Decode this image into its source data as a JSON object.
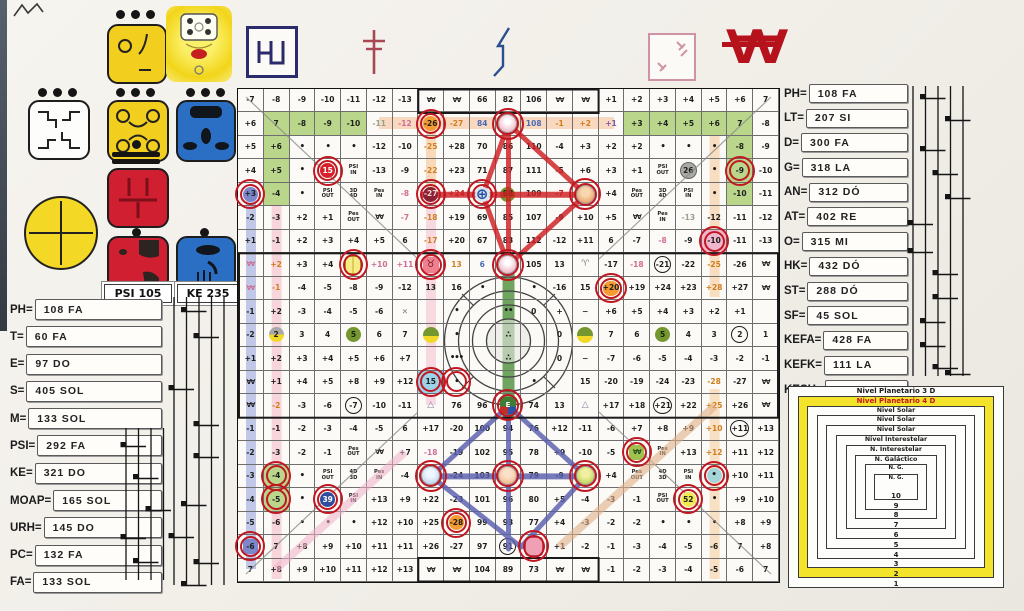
{
  "seals": {
    "psi_label": "PSI 105",
    "ke_label": "KE 235",
    "icons": [
      "white-seal",
      "yellow-seal-1",
      "sun-face",
      "yellow-seal-2",
      "blue-seal-1",
      "yellow-circle-cross",
      "red-seal-1",
      "red-seal-2",
      "blue-seal-2"
    ]
  },
  "top_symbols": {
    "w_glyph": "∀∀"
  },
  "left_panel": {
    "items": [
      {
        "label": "PH=",
        "value": "108 FA"
      },
      {
        "label": "T=",
        "value": "60 FA"
      },
      {
        "label": "E=",
        "value": "97 DO"
      },
      {
        "label": "S=",
        "value": "405 SOL"
      },
      {
        "label": "M=",
        "value": "133 SOL"
      },
      {
        "label": "PSI=",
        "value": "292 FA"
      },
      {
        "label": "KE=",
        "value": "321 DO"
      },
      {
        "label": "MOAP=",
        "value": "165 SOL"
      },
      {
        "label": "URH=",
        "value": "145 DO"
      },
      {
        "label": "PC=",
        "value": "132 FA"
      },
      {
        "label": "FA=",
        "value": "133 SOL"
      }
    ]
  },
  "right_panel": {
    "items": [
      {
        "label": "PH=",
        "value": "108 FA"
      },
      {
        "label": "LT=",
        "value": "207 SI"
      },
      {
        "label": "D=",
        "value": "300 FA"
      },
      {
        "label": "G=",
        "value": "318 LA"
      },
      {
        "label": "AN=",
        "value": "312 DÓ"
      },
      {
        "label": "AT=",
        "value": "402 RE"
      },
      {
        "label": "O=",
        "value": "315 MI"
      },
      {
        "label": "HK=",
        "value": "432 DÓ"
      },
      {
        "label": "ST=",
        "value": "288 DÓ"
      },
      {
        "label": "SF=",
        "value": "45 SOL"
      },
      {
        "label": "KEFA=",
        "value": "428 FA"
      },
      {
        "label": "KEFK=",
        "value": "111 LA"
      },
      {
        "label": "KESH=",
        "value": "367 SI"
      }
    ]
  },
  "nested_squares": {
    "rings": [
      {
        "label": "Nivel Planetario 3 D",
        "number": "1",
        "style": "plain"
      },
      {
        "label": "Nivel Planetario 4 D",
        "number": "2",
        "style": "yellow"
      },
      {
        "label": "Nivel Solar",
        "number": "3",
        "style": "plain"
      },
      {
        "label": "Nivel Solar",
        "number": "4",
        "style": "plain"
      },
      {
        "label": "Nivel Solar",
        "number": "5",
        "style": "plain"
      },
      {
        "label": "Nivel Interestelar",
        "number": "6",
        "style": "plain"
      },
      {
        "label": "N. Interestelar",
        "number": "7",
        "style": "plain"
      },
      {
        "label": "N. Galáctico",
        "number": "8",
        "style": "plain"
      },
      {
        "label": "N. G.",
        "number": "9",
        "style": "plain"
      },
      {
        "label": "N. G.",
        "number": "10",
        "style": "plain"
      }
    ]
  },
  "staffs": {
    "left": {
      "lines": 5,
      "height": 288,
      "notes": [
        [
          1,
          10
        ],
        [
          2,
          36
        ],
        [
          0,
          88
        ],
        [
          2,
          124
        ],
        [
          2,
          156
        ],
        [
          1,
          204
        ],
        [
          0,
          236
        ],
        [
          2,
          262
        ],
        [
          1,
          284
        ]
      ]
    },
    "bottom_left": {
      "lines": 4,
      "height": 152,
      "notes": [
        [
          0,
          14
        ],
        [
          1,
          46
        ],
        [
          2,
          78
        ],
        [
          0,
          106
        ],
        [
          1,
          130
        ]
      ]
    },
    "right": {
      "lines": 5,
      "height": 290,
      "notes": [
        [
          1,
          8
        ],
        [
          3,
          30
        ],
        [
          1,
          60
        ],
        [
          2,
          84
        ],
        [
          3,
          108
        ],
        [
          0,
          134
        ],
        [
          0,
          162
        ],
        [
          2,
          184
        ],
        [
          2,
          208
        ],
        [
          1,
          232
        ],
        [
          1,
          256
        ],
        [
          2,
          278
        ],
        [
          3,
          284
        ]
      ]
    }
  },
  "grid": {
    "rows": [
      [
        "-7",
        "-8",
        "-9",
        "-10",
        "-11",
        "-12",
        "-13",
        {
          "t": "∀∀",
          "c": "w"
        },
        {
          "t": "∀∀",
          "c": "w"
        },
        "66",
        "82",
        "106",
        {
          "t": "∀∀",
          "c": "w"
        },
        {
          "t": "∀∀",
          "c": "w"
        },
        "+1",
        "+2",
        "+3",
        "+4",
        "+5",
        "+6",
        "7"
      ],
      [
        "+6",
        {
          "t": "7",
          "c": "g"
        },
        {
          "t": "-8",
          "c": "g"
        },
        {
          "t": "-9",
          "c": "g"
        },
        {
          "t": "-10",
          "c": "g"
        },
        {
          "t": "-11",
          "c": "txt-gr"
        },
        {
          "t": "-12",
          "c": "txt-p"
        },
        {
          "t": "-26",
          "c": "oc",
          "r": 1
        },
        {
          "t": "-27",
          "c": "txt-o"
        },
        {
          "t": "84",
          "c": "txt-b"
        },
        {
          "t": "",
          "c": "fig fig-rose",
          "r": 1
        },
        {
          "t": "108",
          "c": "txt-b"
        },
        {
          "t": "-1",
          "c": "txt-o"
        },
        {
          "t": "+2",
          "c": "txt-o"
        },
        {
          "t": "+1",
          "c": "txt-v"
        },
        {
          "t": "+3",
          "c": "g"
        },
        {
          "t": "+4",
          "c": "g"
        },
        {
          "t": "+5",
          "c": "g"
        },
        {
          "t": "+6",
          "c": "g"
        },
        {
          "t": "7",
          "c": "g"
        },
        "-8"
      ],
      [
        "+5",
        {
          "t": "+6",
          "c": "g"
        },
        {
          "t": "•",
          "c": "dot"
        },
        {
          "t": "•",
          "c": "dot"
        },
        {
          "t": "•",
          "c": "dot"
        },
        "-12",
        "-10",
        {
          "t": "-25",
          "c": "txt-o"
        },
        "+28",
        "70",
        "86",
        "110",
        "-4",
        "+3",
        "+2",
        "+2",
        {
          "t": "•",
          "c": "dot"
        },
        {
          "t": "•",
          "c": "dot"
        },
        {
          "t": "•",
          "c": "dot"
        },
        {
          "t": "-8",
          "c": "g"
        },
        "-9"
      ],
      [
        "+4",
        {
          "t": "+5",
          "c": "g"
        },
        {
          "t": "•",
          "c": "dot"
        },
        {
          "t": "15",
          "c": "rc",
          "r": 1
        },
        {
          "t": "PSI IN",
          "c": "sm"
        },
        "-13",
        "-9",
        {
          "t": "-22",
          "c": "txt-o"
        },
        "+23",
        "71",
        "87",
        "111",
        "-5",
        "+6",
        "+3",
        "+1",
        {
          "t": "PSI OUT",
          "c": "sm"
        },
        {
          "t": "26",
          "c": "grc"
        },
        {
          "t": "•",
          "c": "dot"
        },
        {
          "t": "-9",
          "c": "g",
          "r": 1
        },
        "-10"
      ],
      [
        {
          "t": "+3",
          "c": "bc",
          "r": 1
        },
        {
          "t": "-4",
          "c": "g"
        },
        {
          "t": "•",
          "c": "dot"
        },
        {
          "t": "PSI OUT",
          "c": "sm"
        },
        {
          "t": "3D 4D",
          "c": "sm"
        },
        {
          "t": "Pes IN",
          "c": "sm"
        },
        {
          "t": "-8",
          "c": "txt-p"
        },
        {
          "t": "-27",
          "c": "mc",
          "r": 1
        },
        {
          "t": "+24",
          "c": "txt-r"
        },
        {
          "t": "⊕",
          "c": "globe",
          "r": 1
        },
        {
          "t": "88",
          "c": "gc"
        },
        "109",
        {
          "t": "-7",
          "c": "txt-r"
        },
        {
          "t": "",
          "c": "fig fig-orange",
          "r": 1
        },
        "+4",
        {
          "t": "Pes OUT",
          "c": "sm"
        },
        {
          "t": "3D 4D",
          "c": "sm"
        },
        {
          "t": "PSI IN",
          "c": "sm"
        },
        {
          "t": "•",
          "c": "dot"
        },
        {
          "t": "-10",
          "c": "g"
        },
        "-11"
      ],
      [
        "-2",
        "-3",
        "+2",
        "+1",
        {
          "t": "Pes OUT",
          "c": "sm"
        },
        {
          "t": "∀∀",
          "c": "w"
        },
        {
          "t": "-7",
          "c": "txt-p"
        },
        {
          "t": "-18",
          "c": "txt-o"
        },
        "+19",
        "69",
        "85",
        "107",
        "-9",
        "+10",
        "+5",
        {
          "t": "∀∀",
          "c": "w"
        },
        {
          "t": "Pes IN",
          "c": "sm"
        },
        {
          "t": "-13",
          "c": "txt-gr"
        },
        "-12",
        "-11",
        "-12"
      ],
      [
        "+1",
        "-1",
        "+2",
        "+3",
        "+4",
        "+5",
        "6",
        {
          "t": "-17",
          "c": "txt-o"
        },
        "+20",
        "67",
        "83",
        "112",
        "-12",
        "+11",
        "6",
        "-7",
        {
          "t": "-8",
          "c": "txt-p"
        },
        "-9",
        {
          "t": "-10",
          "c": "pc2",
          "r": 1
        },
        "-11",
        "-13"
      ],
      [
        {
          "t": "∀∀",
          "c": "w txt-p"
        },
        {
          "t": "+2",
          "c": "txt-o"
        },
        "+3",
        "+4",
        {
          "t": "",
          "c": "glyph-y",
          "r": 1
        },
        {
          "t": "+10",
          "c": "txt-p"
        },
        {
          "t": "+11",
          "c": "txt-p"
        },
        {
          "t": "♉",
          "c": "tau",
          "r": 1
        },
        {
          "t": "13",
          "c": "txt-o"
        },
        {
          "t": "6",
          "c": "txt-b"
        },
        {
          "t": "",
          "c": "fig fig-rose",
          "r": 1
        },
        "105",
        "13",
        {
          "t": "♈",
          "c": "ari"
        },
        "-17",
        {
          "t": "-18",
          "c": "txt-p"
        },
        {
          "t": "-21",
          "c": "kc"
        },
        "-22",
        {
          "t": "-25",
          "c": "txt-o"
        },
        "-26",
        {
          "t": "∀∀",
          "c": "w"
        }
      ],
      [
        {
          "t": "∀∀",
          "c": "w txt-p"
        },
        {
          "t": "-1",
          "c": "txt-o"
        },
        "-4",
        "-5",
        "-8",
        "-9",
        "-12",
        "13",
        "16",
        {
          "t": "•",
          "c": "dot"
        },
        "",
        {
          "t": "•",
          "c": "dot"
        },
        "-16",
        "15",
        {
          "t": "+20",
          "c": "oc",
          "r": 1
        },
        "+19",
        "+24",
        "+23",
        {
          "t": "+28",
          "c": "txt-o"
        },
        "+27",
        {
          "t": "∀∀",
          "c": "w"
        }
      ],
      [
        "-1",
        "+2",
        "-3",
        "-4",
        "-5",
        "-6",
        {
          "t": "✕",
          "c": "xg"
        },
        "",
        {
          "t": "•",
          "c": "dot"
        },
        "",
        {
          "t": "••",
          "c": "dot"
        },
        "0",
        "+",
        "−",
        "+6",
        "+5",
        "+4",
        "+3",
        "+2",
        "+1",
        ""
      ],
      [
        "-2",
        {
          "t": "2",
          "c": "hgy"
        },
        "3",
        "4",
        {
          "t": "5",
          "c": "gc"
        },
        "6",
        "7",
        {
          "t": "",
          "c": "hgg"
        },
        {
          "t": "•",
          "c": "dot"
        },
        "",
        {
          "t": "∴",
          "c": "dot"
        },
        "",
        "0",
        {
          "t": "",
          "c": "hgg"
        },
        "7",
        "6",
        {
          "t": "5",
          "c": "gc"
        },
        "4",
        "3",
        {
          "t": "2",
          "c": "kc"
        },
        "1"
      ],
      [
        "+1",
        "+2",
        "+3",
        "+4",
        "+5",
        "+6",
        "+7",
        "",
        {
          "t": "•••",
          "c": "dot"
        },
        "",
        {
          "t": "∴",
          "c": "dot"
        },
        "",
        "0",
        "−",
        "-7",
        "-6",
        "-5",
        "-4",
        "-3",
        "-2",
        "-1"
      ],
      [
        {
          "t": "∀∀",
          "c": "w"
        },
        "+1",
        "+4",
        "+5",
        "+8",
        "+9",
        "+12",
        {
          "t": "15",
          "c": "lbc",
          "r": 1
        },
        {
          "t": "•",
          "c": "dot",
          "r": 1
        },
        "",
        "",
        {
          "t": "•",
          "c": "dot"
        },
        "",
        "15",
        "-20",
        "-19",
        "-24",
        "-23",
        {
          "t": "-28",
          "c": "txt-o"
        },
        "-27",
        {
          "t": "∀∀",
          "c": "w"
        }
      ],
      [
        {
          "t": "∀∀",
          "c": "w"
        },
        {
          "t": "-2",
          "c": "txt-o"
        },
        "-3",
        "-6",
        {
          "t": "-7",
          "c": "kc"
        },
        "-10",
        "-11",
        {
          "t": "△",
          "c": "tri"
        },
        "76",
        "96",
        {
          "t": "E",
          "c": "glyph-e",
          "r": 1
        },
        "74",
        "13",
        {
          "t": "△",
          "c": "tri"
        },
        "+17",
        "+18",
        {
          "t": "+21",
          "c": "kc"
        },
        "+22",
        {
          "t": "+25",
          "c": "txt-o"
        },
        "+26",
        {
          "t": "∀∀",
          "c": "w"
        }
      ],
      [
        "-1",
        "-1",
        "-2",
        "-3",
        "-4",
        "-5",
        "6",
        "+17",
        "-20",
        "100",
        "94",
        "76",
        "+12",
        "-11",
        "-6",
        "+7",
        "+8",
        "+9",
        {
          "t": "+10",
          "c": "txt-o"
        },
        {
          "t": "+11",
          "c": "kc"
        },
        "+13"
      ],
      [
        "-2",
        "-3",
        "-2",
        "-1",
        {
          "t": "Pes OUT",
          "c": "sm"
        },
        {
          "t": "∀∀",
          "c": "w"
        },
        "+7",
        {
          "t": "-18",
          "c": "txt-p"
        },
        "-19",
        "102",
        "95",
        "78",
        "+9",
        "-10",
        "-5",
        {
          "t": "∀∀",
          "c": "w gbg",
          "r": 1
        },
        {
          "t": "Pes IN",
          "c": "sm"
        },
        "+13",
        {
          "t": "+12",
          "c": "txt-o"
        },
        "+11",
        "+12"
      ],
      [
        "-3",
        {
          "t": "-4",
          "c": "g",
          "r": 1
        },
        {
          "t": "•",
          "c": "dot"
        },
        {
          "t": "PSI OUT",
          "c": "sm"
        },
        {
          "t": "4D 3D",
          "c": "sm"
        },
        {
          "t": "Pes IN",
          "c": "sm"
        },
        "-4",
        {
          "t": "",
          "c": "fig fig-blue",
          "r": 1
        },
        "-24",
        "103",
        {
          "t": "",
          "c": "fig fig-orange2",
          "r": 1
        },
        "79",
        "-9",
        {
          "t": "",
          "c": "fig fig-green",
          "r": 1
        },
        "+4",
        {
          "t": "Pes OUT",
          "c": "sm"
        },
        {
          "t": "4D 3D",
          "c": "sm"
        },
        {
          "t": "PSI IN",
          "c": "sm"
        },
        {
          "t": "•",
          "c": "cc",
          "r": 1
        },
        "+10",
        "+11"
      ],
      [
        "-4",
        {
          "t": "-5",
          "c": "g",
          "r": 1
        },
        {
          "t": "•",
          "c": "dot"
        },
        {
          "t": "39",
          "c": "nc",
          "r": 1
        },
        {
          "t": "PSI IN",
          "c": "sm"
        },
        "+13",
        "+9",
        "+22",
        "-23",
        "101",
        "96",
        "80",
        "+5",
        "-4",
        "-3",
        "-1",
        {
          "t": "PSI OUT",
          "c": "sm"
        },
        {
          "t": "52",
          "c": "yc",
          "r": 1
        },
        {
          "t": "•",
          "c": "dot"
        },
        "+9",
        "+10"
      ],
      [
        "-5",
        "-6",
        {
          "t": "•",
          "c": "dot"
        },
        {
          "t": "•",
          "c": "dot"
        },
        {
          "t": "•",
          "c": "dot"
        },
        "+12",
        "+10",
        "+25",
        {
          "t": "-28",
          "c": "oc",
          "r": 1
        },
        "99",
        "93",
        "77",
        "+4",
        "-3",
        "-2",
        "-2",
        {
          "t": "•",
          "c": "dot"
        },
        {
          "t": "•",
          "c": "dot"
        },
        {
          "t": "•",
          "c": "dot"
        },
        "+8",
        "+9"
      ],
      [
        {
          "t": "-6",
          "c": "bsq",
          "r": 1
        },
        "7",
        "+8",
        "+9",
        "+10",
        "+11",
        "+11",
        "+26",
        "-27",
        "97",
        {
          "t": "91",
          "c": "kc"
        },
        {
          "t": "",
          "c": "glyph-p",
          "r": 1
        },
        "+1",
        "-2",
        "-1",
        "-3",
        "-4",
        "-5",
        "-6",
        "7",
        "+8"
      ],
      [
        "7",
        "+8",
        "+9",
        "+10",
        "+11",
        "+12",
        "+13",
        {
          "t": "∀∀",
          "c": "w"
        },
        {
          "t": "∀∀",
          "c": "w"
        },
        "104",
        "89",
        "73",
        {
          "t": "∀∀",
          "c": "w"
        },
        {
          "t": "∀∀",
          "c": "w"
        },
        "-1",
        "-2",
        "-3",
        "-4",
        "-5",
        "-6",
        "7"
      ]
    ]
  },
  "colors": {
    "accent_red": "#c01822",
    "grid_green": "#b9d68b",
    "stripe_blue": "#8894d8",
    "stripe_pink": "#f2a8b8",
    "stripe_orange": "#f5c08a",
    "center_green": "#4e8f3c",
    "triangle_red": "#cf1f24",
    "triangle_blue": "#5a5fae",
    "ring_yellow": "#f4e32b"
  }
}
